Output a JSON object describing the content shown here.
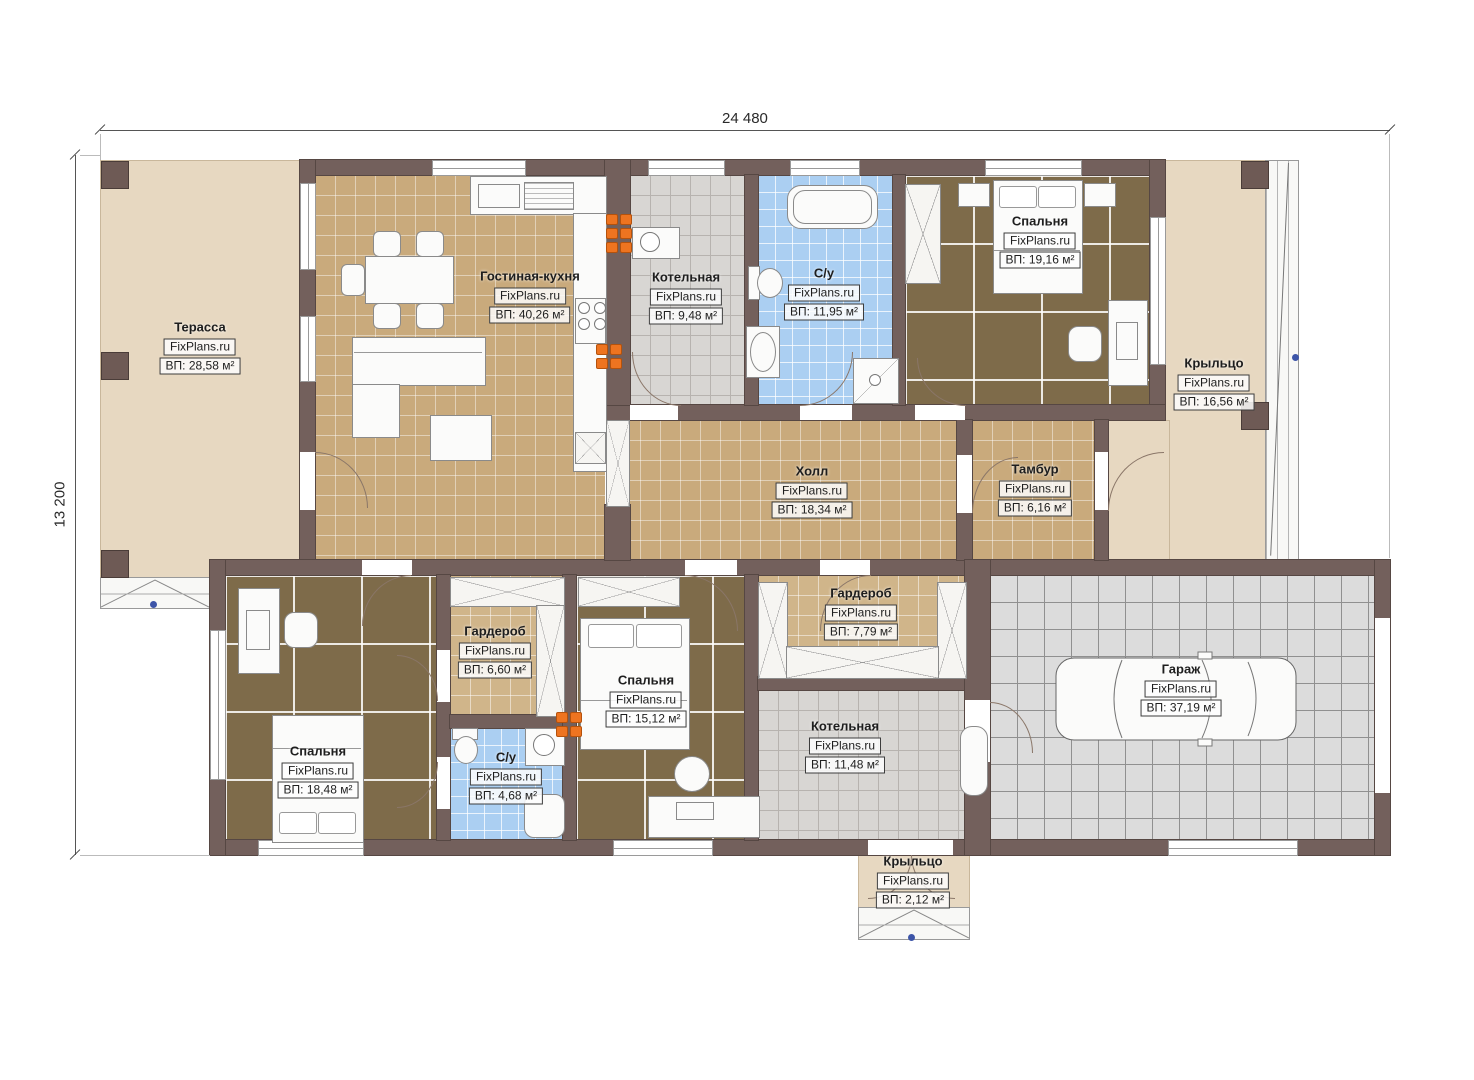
{
  "dimensions": {
    "width": "24 480",
    "height": "13 200"
  },
  "rooms": [
    {
      "id": "terrace",
      "name": "Терасса",
      "source": "FixPlans.ru",
      "area": "ВП: 28,58 м²"
    },
    {
      "id": "living-kitchen",
      "name": "Гостиная-кухня",
      "source": "FixPlans.ru",
      "area": "ВП: 40,26 м²"
    },
    {
      "id": "boiler-top",
      "name": "Котельная",
      "source": "FixPlans.ru",
      "area": "ВП: 9,48 м²"
    },
    {
      "id": "bathroom-top",
      "name": "С/у",
      "source": "FixPlans.ru",
      "area": "ВП: 11,95 м²"
    },
    {
      "id": "bedroom-top",
      "name": "Спальня",
      "source": "FixPlans.ru",
      "area": "ВП: 19,16 м²"
    },
    {
      "id": "porch-right",
      "name": "Крыльцо",
      "source": "FixPlans.ru",
      "area": "ВП: 16,56 м²"
    },
    {
      "id": "hall",
      "name": "Холл",
      "source": "FixPlans.ru",
      "area": "ВП: 18,34 м²"
    },
    {
      "id": "vestibule",
      "name": "Тамбур",
      "source": "FixPlans.ru",
      "area": "ВП: 6,16 м²"
    },
    {
      "id": "wardrobe-left",
      "name": "Гардероб",
      "source": "FixPlans.ru",
      "area": "ВП: 6,60 м²"
    },
    {
      "id": "bathroom-bottom",
      "name": "С/у",
      "source": "FixPlans.ru",
      "area": "ВП: 4,68 м²"
    },
    {
      "id": "bedroom-left",
      "name": "Спальня",
      "source": "FixPlans.ru",
      "area": "ВП: 18,48 м²"
    },
    {
      "id": "bedroom-mid",
      "name": "Спальня",
      "source": "FixPlans.ru",
      "area": "ВП: 15,12 м²"
    },
    {
      "id": "wardrobe-mid",
      "name": "Гардероб",
      "source": "FixPlans.ru",
      "area": "ВП: 7,79 м²"
    },
    {
      "id": "boiler-bottom",
      "name": "Котельная",
      "source": "FixPlans.ru",
      "area": "ВП: 11,48 м²"
    },
    {
      "id": "garage",
      "name": "Гараж",
      "source": "FixPlans.ru",
      "area": "ВП: 37,19 м²"
    },
    {
      "id": "porch-bottom",
      "name": "Крыльцо",
      "source": "FixPlans.ru",
      "area": "ВП: 2,12 м²"
    }
  ],
  "colors": {
    "wall": "#73605c",
    "deck_beige": "#e7d8c1",
    "living_tile": "#c9aa7c",
    "bedroom_tile": "#7e6b4a",
    "bath_tile": "#abcff2",
    "boiler_tile": "#d8d6d3",
    "garage_tile": "#dcdcdc",
    "wardrobe_tile": "#d0b58a",
    "electric_orange": "#ee7420",
    "marker_blue": "#3d55a8"
  }
}
